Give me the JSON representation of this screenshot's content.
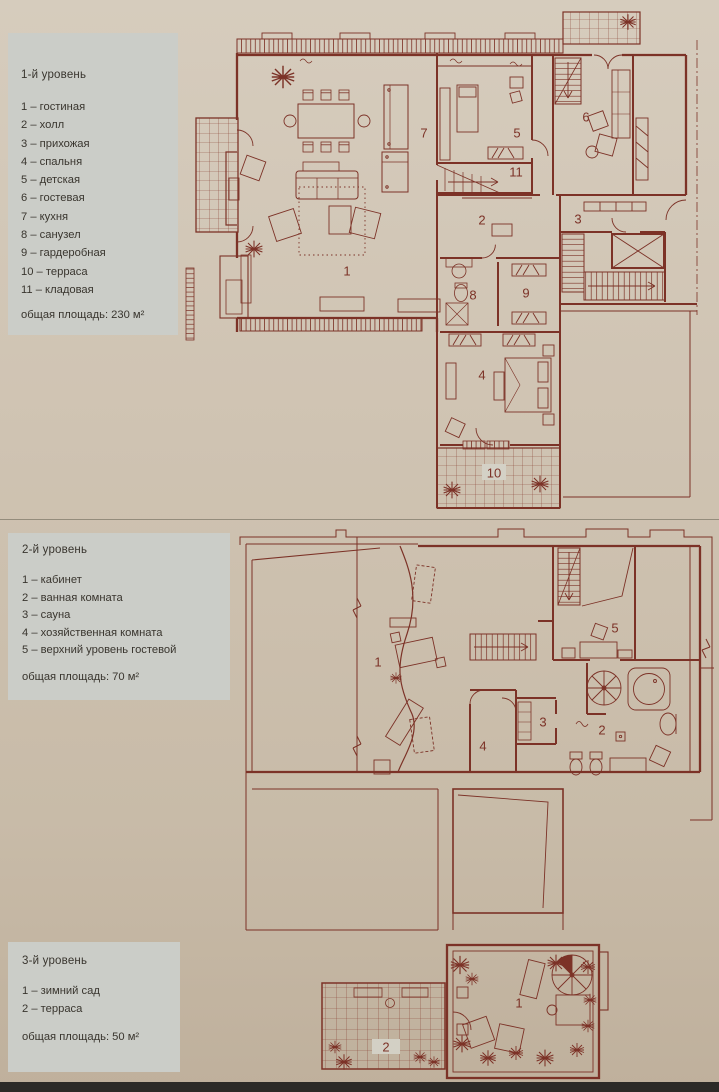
{
  "palette": {
    "page_background": "#cfc3b2",
    "legend_panel": "#cbcdc8",
    "text_ink": "#39352e",
    "plan_line": "#7c3227"
  },
  "levels": [
    {
      "title": "1-й уровень",
      "items": [
        "1 – гостиная",
        "2 – холл",
        "3 – прихожая",
        "4 – спальня",
        "5 – детская",
        "6 – гостевая",
        "7 – кухня",
        "8 – санузел",
        "9 – гардеробная",
        "10 – терраса",
        "11 – кладовая"
      ],
      "total": "общая площадь: 230 м²",
      "plan_labels": [
        "1",
        "7",
        "5",
        "6",
        "11",
        "2",
        "3",
        "8",
        "9",
        "4",
        "10"
      ]
    },
    {
      "title": "2-й уровень",
      "items": [
        "1 – кабинет",
        "2 – ванная комната",
        "3 – сауна",
        "4 – хозяйственная комната",
        "5 – верхний уровень гостевой"
      ],
      "total": "общая площадь: 70 м²",
      "plan_labels": [
        "1",
        "5",
        "3",
        "2",
        "4"
      ]
    },
    {
      "title": "3-й уровень",
      "items": [
        "1 – зимний сад",
        "2 – терраса"
      ],
      "total": "общая площадь: 50 м²",
      "plan_labels": [
        "1",
        "2"
      ]
    }
  ]
}
